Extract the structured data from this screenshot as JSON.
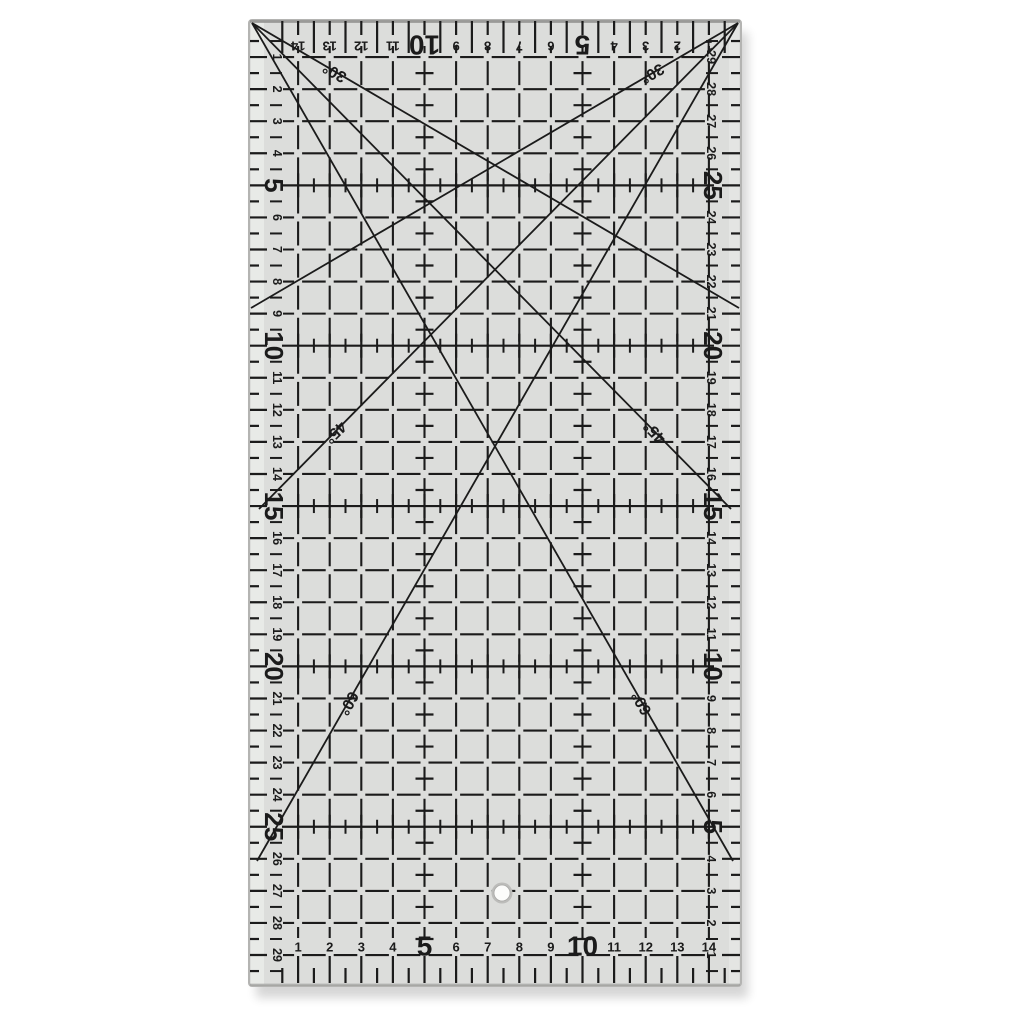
{
  "scene": {
    "background_color": "#ffffff",
    "description": "Photo of a transparent acrylic quilting grid ruler with centimeter markings, angle lines and a hanging hole"
  },
  "ruler": {
    "body_color": "#dcdddb",
    "margin_highlight_color": "#ecedeb",
    "edge_color": "#8f8f8d",
    "border_color": "#b4b4b2",
    "print_color": "#1b1b1b",
    "shadow_color": "#000000",
    "hole": {
      "fill": "#fcfcfb",
      "ring_color": "#bcbcba"
    },
    "scales": {
      "top": {
        "unit_numbers": [
          1,
          2,
          3,
          4,
          5,
          6,
          7,
          8,
          9,
          10,
          11,
          12,
          13,
          14
        ],
        "bold_numbers": [
          5,
          10
        ]
      },
      "bottom": {
        "unit_numbers": [
          1,
          2,
          3,
          4,
          5,
          6,
          7,
          8,
          9,
          10,
          11,
          12,
          13,
          14
        ],
        "bold_numbers": [
          5,
          10
        ]
      },
      "left": {
        "unit_numbers": [
          1,
          2,
          3,
          4,
          5,
          6,
          7,
          8,
          9,
          10,
          11,
          12,
          13,
          14,
          15,
          16,
          17,
          18,
          19,
          20,
          21,
          22,
          23,
          24,
          25,
          26,
          27,
          28,
          29
        ],
        "bold_numbers": [
          5,
          10,
          15,
          20,
          25
        ]
      },
      "right": {
        "unit_numbers": [
          1,
          2,
          3,
          4,
          5,
          6,
          7,
          8,
          9,
          10,
          11,
          12,
          13,
          14,
          15,
          16,
          17,
          18,
          19,
          20,
          21,
          22,
          23,
          24,
          25,
          26,
          27,
          28,
          29
        ],
        "bold_numbers": [
          5,
          10,
          15,
          20,
          25
        ]
      }
    },
    "grid": {
      "tick_rows": [
        5,
        10,
        15,
        20,
        25
      ],
      "cross_columns": [
        5,
        10
      ]
    },
    "angle_labels": {
      "deg30": "30°",
      "deg45": "45°",
      "deg60": "60°"
    }
  }
}
